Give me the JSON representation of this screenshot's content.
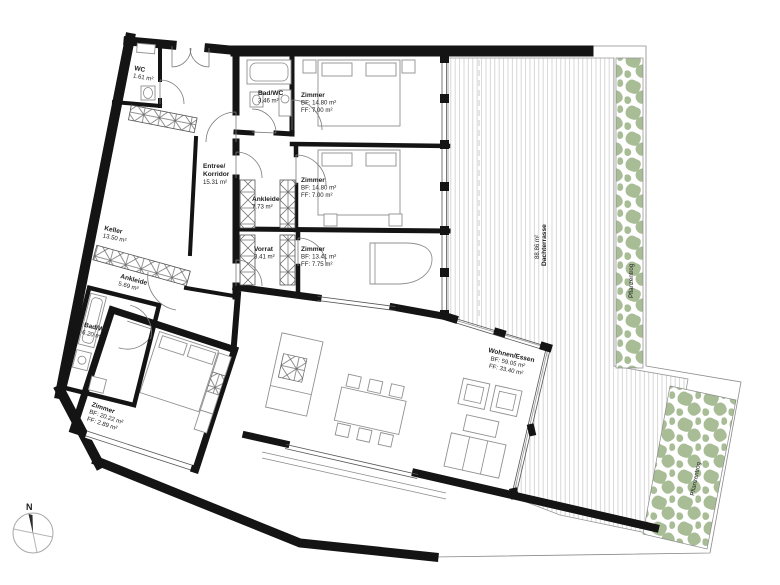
{
  "title": "Apartment floor plan",
  "rooms": {
    "wc": {
      "name": "WC",
      "area": "1.61 m²"
    },
    "bad_wc": {
      "name": "Bad/WC",
      "area": "3.46 m²"
    },
    "zimmer1": {
      "name": "Zimmer",
      "bf": "BF: 14.80 m²",
      "ff": "FF: 7.00 m²"
    },
    "zimmer2": {
      "name": "Zimmer",
      "bf": "BF: 14.80 m²",
      "ff": "FF: 7.00 m²"
    },
    "entree": {
      "name1": "Entree/",
      "name2": "Korridor",
      "area": "15.31 m²"
    },
    "ankleide1": {
      "name": "Ankleide",
      "area": "7.73 m²"
    },
    "vorrat": {
      "name": "Vorrat",
      "area": "3.41 m²"
    },
    "zimmer3": {
      "name": "Zimmer",
      "bf": "BF: 13.41 m²",
      "ff": "FF: 7.75 m²"
    },
    "keller": {
      "name": "Keller",
      "area": "13.50 m²"
    },
    "ankleide2": {
      "name": "Ankleide",
      "area": "5.69 m²"
    },
    "bad_wc2": {
      "name": "Bad/WC",
      "area": "6.20 m²"
    },
    "zimmer4": {
      "name": "Zimmer",
      "bf": "BF: 20.22 m²",
      "ff": "FF: 2.89 m²"
    },
    "wohnen": {
      "name": "Wohnen/Essen",
      "bf": "BF: 59.05 m²",
      "ff": "FF: 33.40 m²"
    },
    "dachterrasse": {
      "name": "Dachterrasse",
      "area": "88.86 m²"
    },
    "pflanzentrog_right": {
      "name": "Pflanzentrog"
    },
    "pflanzentrog_bottom": {
      "name": "Pflanzentrog"
    }
  },
  "compass": {
    "north_label": "N"
  },
  "colors": {
    "wall": "#141414",
    "plant_green": "#a8bd96",
    "deck_stripe": "#d3d3d3",
    "text": "#1c1c1c"
  }
}
